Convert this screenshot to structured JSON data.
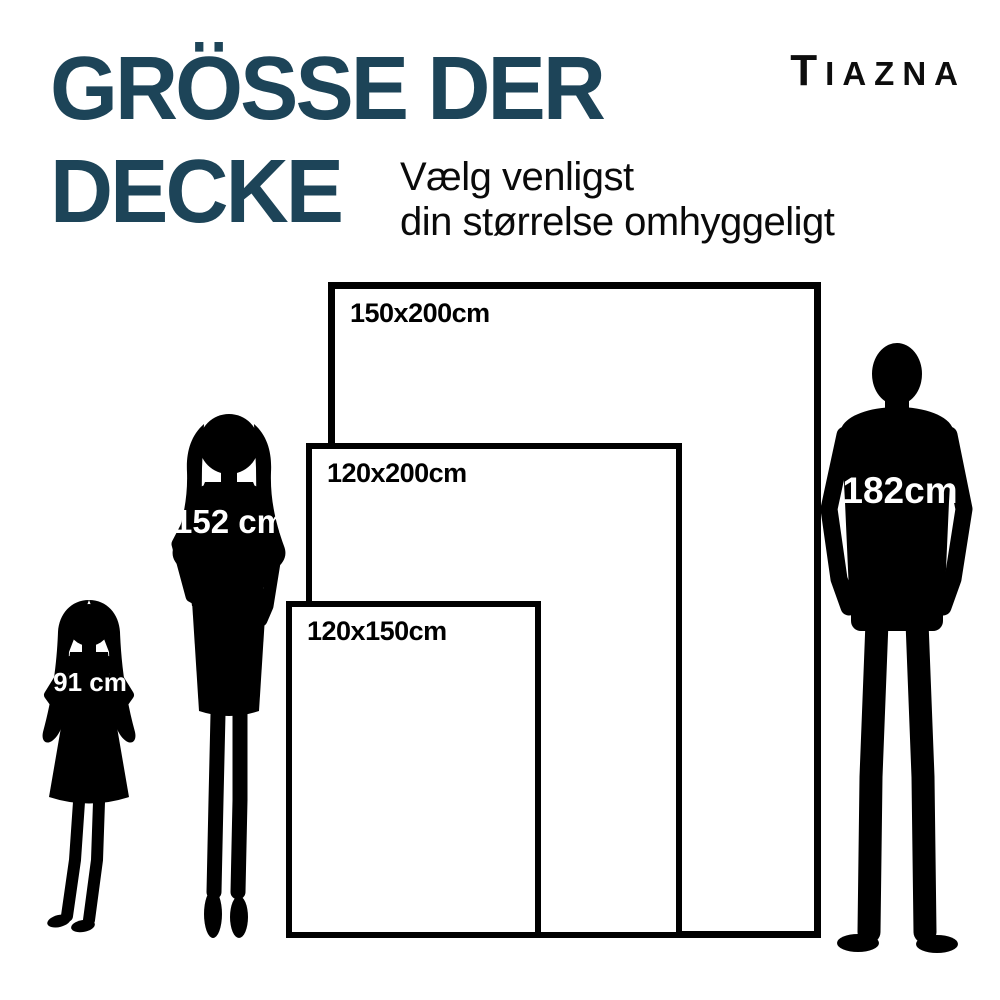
{
  "header": {
    "title_line1": "GRÖSSE DER",
    "title_line2": "DECKE",
    "subtitle_line1": "Vælg venligst",
    "subtitle_line2": "din størrelse omhyggeligt",
    "brand": "TIAZNA"
  },
  "colors": {
    "title": "#1d4458",
    "text": "#000000",
    "silhouette": "#000000",
    "label_on_silhouette": "#ffffff",
    "background": "#ffffff"
  },
  "size_chart": {
    "blanket_sizes": [
      {
        "id": "large",
        "label": "150x200cm",
        "width_cm": 150,
        "length_cm": 200
      },
      {
        "id": "medium",
        "label": "120x200cm",
        "width_cm": 120,
        "length_cm": 200
      },
      {
        "id": "small",
        "label": "120x150cm",
        "width_cm": 120,
        "length_cm": 150
      }
    ],
    "people": [
      {
        "id": "girl",
        "label": "91 cm",
        "height_cm": 91
      },
      {
        "id": "woman",
        "label": "152 cm",
        "height_cm": 152
      },
      {
        "id": "man",
        "label": "182cm",
        "height_cm": 182
      }
    ]
  }
}
